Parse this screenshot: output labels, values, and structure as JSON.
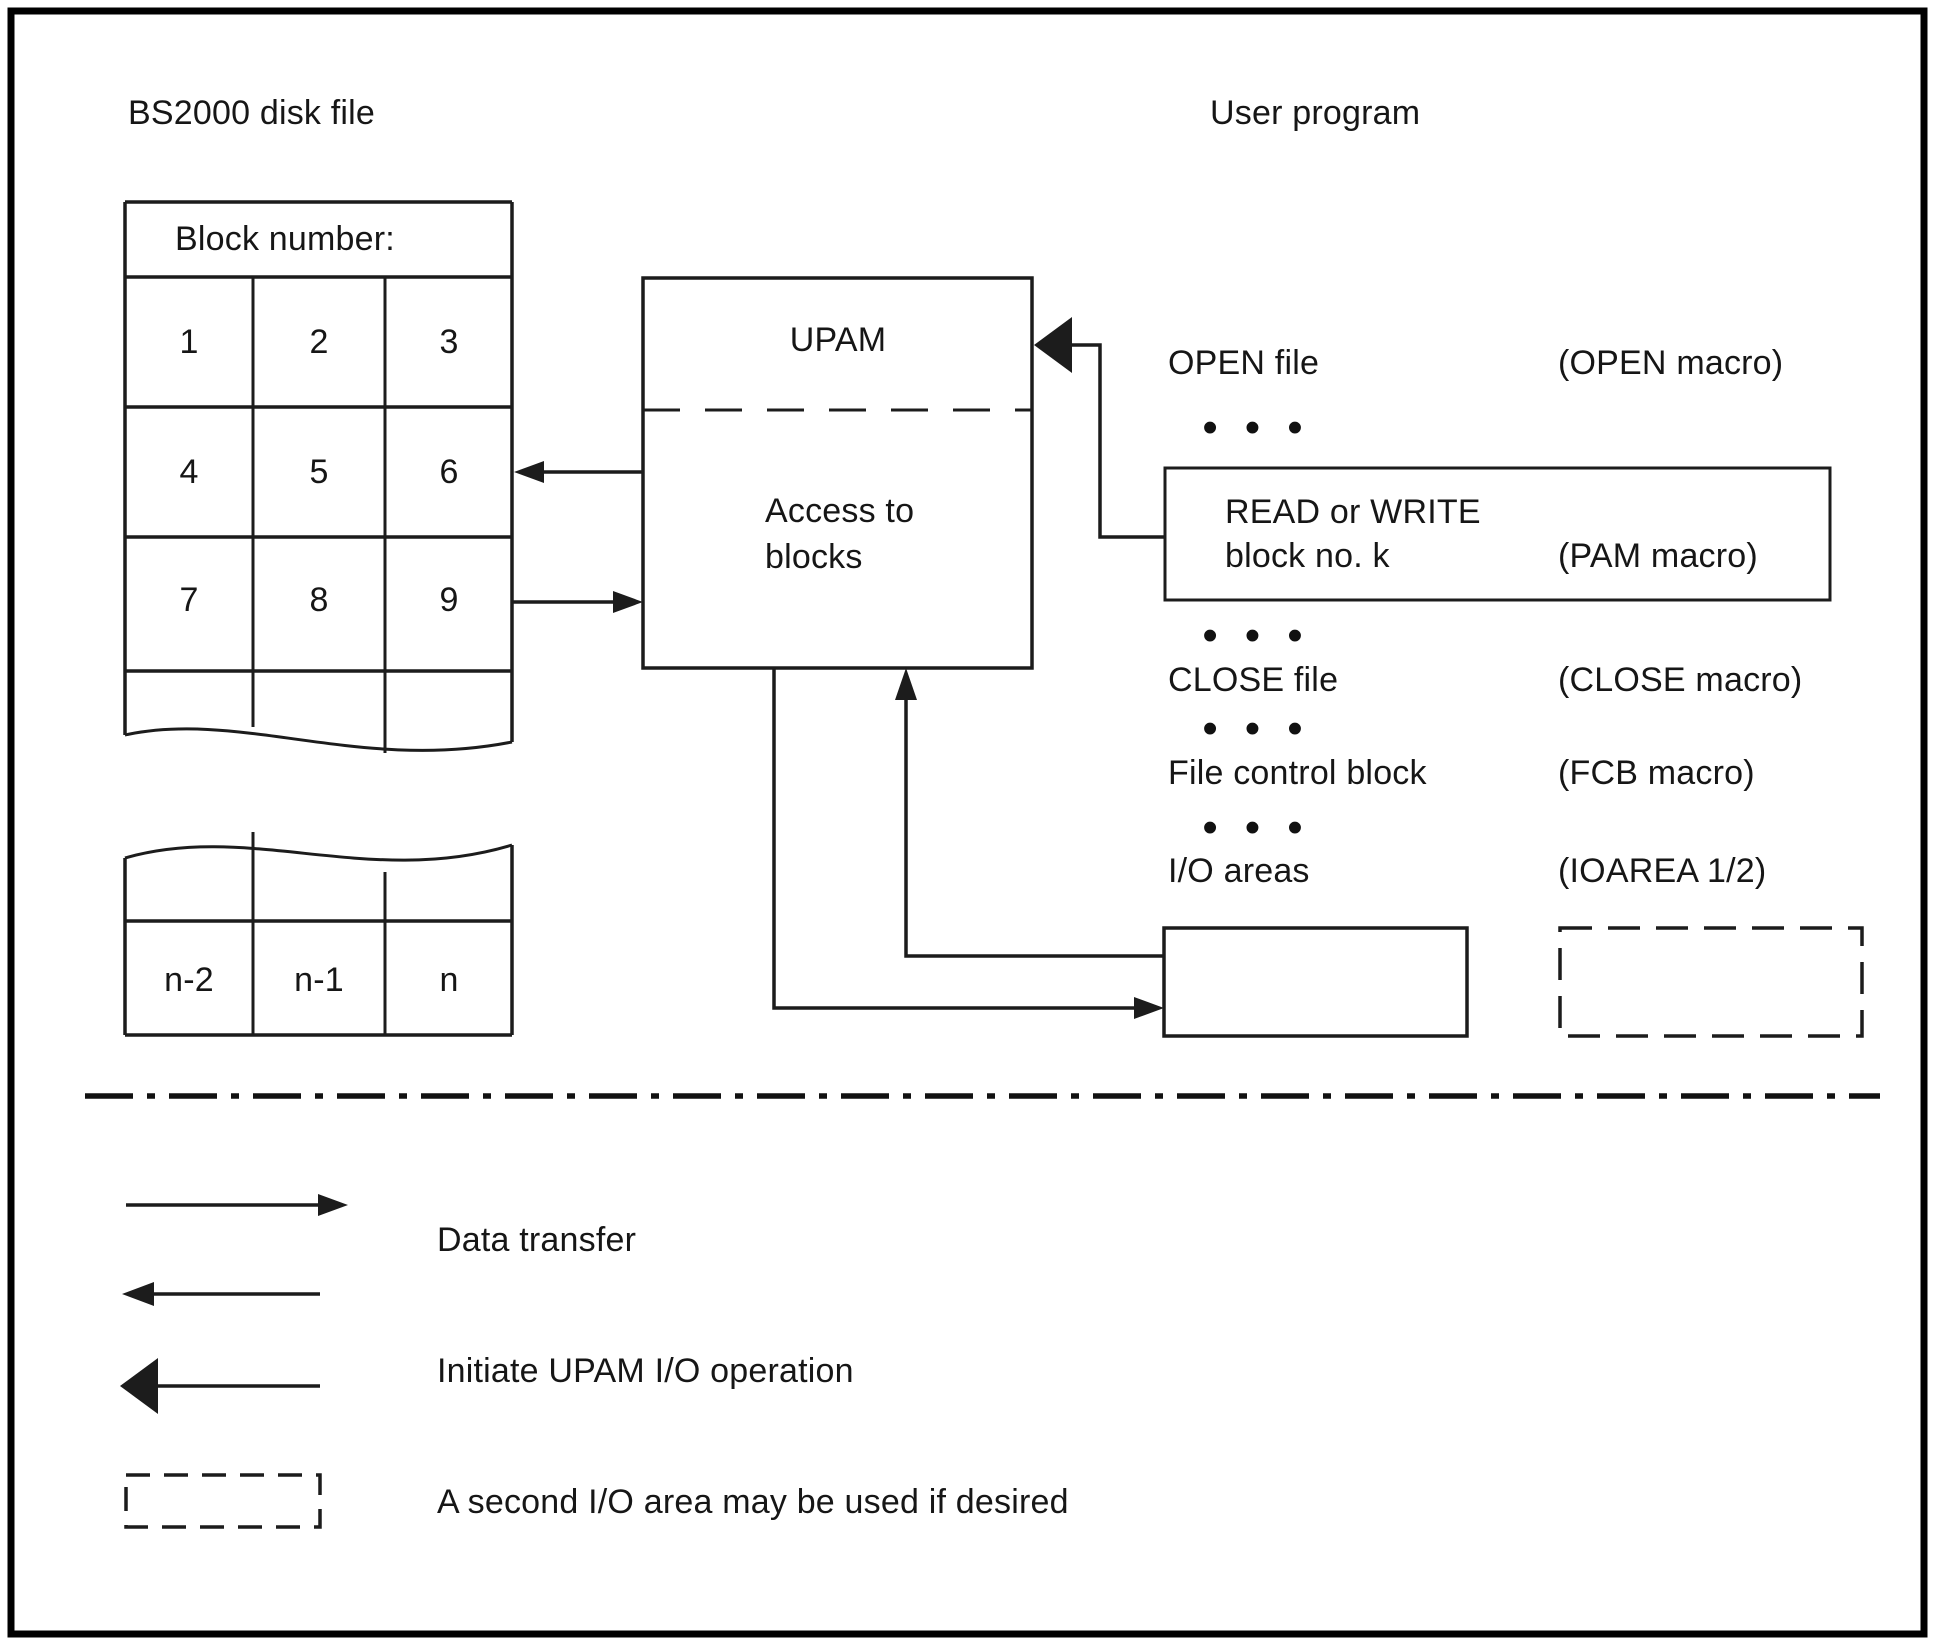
{
  "titles": {
    "left": "BS2000 disk file",
    "right": "User program"
  },
  "disk_file": {
    "header": "Block number:",
    "blocks": [
      "1",
      "2",
      "3",
      "4",
      "5",
      "6",
      "7",
      "8",
      "9"
    ],
    "tail_blocks": [
      "n-2",
      "n-1",
      "n"
    ]
  },
  "upam": {
    "title": "UPAM",
    "subtitle_line1": "Access to",
    "subtitle_line2": "blocks"
  },
  "program": {
    "ellipsis": "•••",
    "open": {
      "label": "OPEN file",
      "macro": "(OPEN macro)"
    },
    "read": {
      "line1": "READ or WRITE",
      "line2": "block no. k",
      "macro": "(PAM macro)"
    },
    "close": {
      "label": "CLOSE file",
      "macro": "(CLOSE macro)"
    },
    "fcb": {
      "label": "File control block",
      "macro": "(FCB macro)"
    },
    "io": {
      "label": "I/O areas",
      "macro": "(IOAREA 1/2)"
    }
  },
  "legend": {
    "data_transfer": "Data transfer",
    "initiate": "Initiate UPAM I/O operation",
    "second_io": "A second I/O area may be used if desired"
  },
  "colors": {
    "line": "#1c1c1c",
    "text": "#161616",
    "background": "#ffffff"
  }
}
